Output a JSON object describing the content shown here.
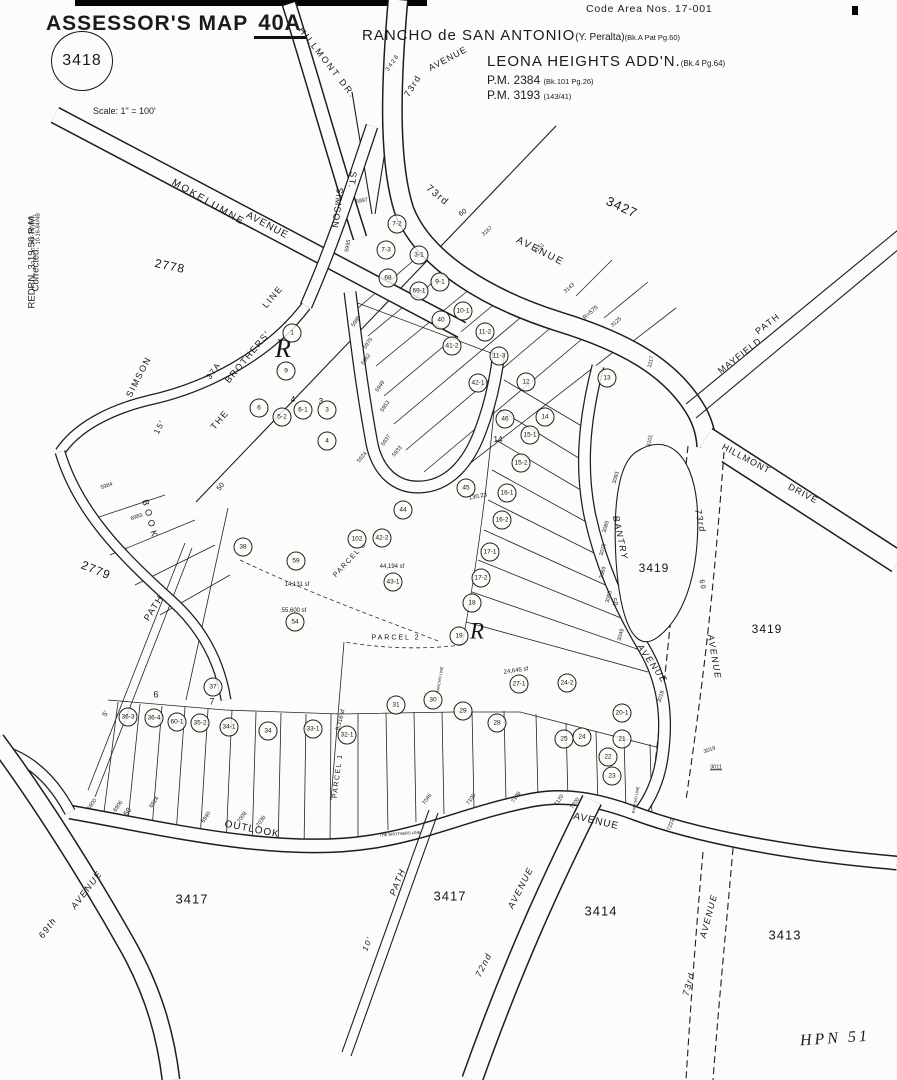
{
  "header": {
    "title": "ASSESSOR'S MAP",
    "map_number": "40A",
    "book_circle": "3418",
    "scale_label": "Scale: 1\" = 100'",
    "code_area": "Code Area Nos. 17-001",
    "rancho_line": "RANCHO de SAN ANTONIO",
    "rancho_sub": "(Y. Peralta)",
    "rancho_ref": "(Bk.A Pat Pg.60)",
    "addition_line": "LEONA HEIGHTS ADD'N.",
    "addition_ref": "(Bk.4 Pg.64)",
    "pm1": "P.M. 2384",
    "pm1_ref": "(Bk.101 Pg.26)",
    "pm2": "P.M. 3193",
    "pm2_ref": "(143/41)",
    "redrawn": "REDRN. 3-19-56 R.M.",
    "corrected_label": "Corrected:",
    "corrected_date1": "5-2-78/W78",
    "corrected_date2": "10-16-84/NB",
    "footer_mark": "HPN 51"
  },
  "map": {
    "street_labels": [
      {
        "t": "HILLMONT DR.",
        "x": 327,
        "y": 63,
        "r": 52,
        "fs": 9,
        "ls": 2
      },
      {
        "t": "73rd",
        "x": 413,
        "y": 86,
        "r": -58,
        "fs": 9
      },
      {
        "t": "AVENUE",
        "x": 448,
        "y": 59,
        "r": -28,
        "fs": 9,
        "ls": 1
      },
      {
        "t": "3428",
        "x": 393,
        "y": 63,
        "r": -55,
        "fs": 6
      },
      {
        "t": "MOKELUMNE",
        "x": 208,
        "y": 203,
        "r": 30,
        "fs": 10,
        "ls": 2
      },
      {
        "t": "AVENUE",
        "x": 267,
        "y": 226,
        "r": 28,
        "fs": 10,
        "ls": 1
      },
      {
        "t": "SIMSON",
        "x": 337,
        "y": 208,
        "r": 97,
        "fs": 9,
        "ls": 1
      },
      {
        "t": "ST.",
        "x": 352,
        "y": 180,
        "r": 97,
        "fs": 9
      },
      {
        "t": "73rd",
        "x": 437,
        "y": 196,
        "r": 40,
        "fs": 10
      },
      {
        "t": "AVENUE",
        "x": 540,
        "y": 252,
        "r": 27,
        "fs": 10,
        "ls": 2
      },
      {
        "t": "MAYFIELD",
        "x": 740,
        "y": 356,
        "r": -38,
        "fs": 9,
        "ls": 1
      },
      {
        "t": "PATH",
        "x": 768,
        "y": 324,
        "r": -38,
        "fs": 9
      },
      {
        "t": "HILLMONT",
        "x": 746,
        "y": 459,
        "r": 28,
        "fs": 9,
        "ls": 1
      },
      {
        "t": "DRIVE",
        "x": 803,
        "y": 494,
        "r": 28,
        "fs": 9,
        "ls": 1
      },
      {
        "t": "73rd",
        "x": 700,
        "y": 521,
        "r": 78,
        "fs": 9,
        "i": 1
      },
      {
        "t": "60",
        "x": 702,
        "y": 585,
        "r": 78,
        "fs": 7
      },
      {
        "t": "AVENUE",
        "x": 714,
        "y": 657,
        "r": 80,
        "fs": 9,
        "i": 1
      },
      {
        "t": "BANTRY",
        "x": 620,
        "y": 538,
        "r": 78,
        "fs": 9,
        "i": 1
      },
      {
        "t": "AVENUE",
        "x": 652,
        "y": 664,
        "r": 55,
        "fs": 9,
        "i": 1
      },
      {
        "t": "THE",
        "x": 220,
        "y": 420,
        "r": -50,
        "fs": 9
      },
      {
        "t": "BROTHERS'",
        "x": 248,
        "y": 357,
        "r": -50,
        "fs": 9
      },
      {
        "t": "LINE",
        "x": 273,
        "y": 297,
        "r": -50,
        "fs": 9
      },
      {
        "t": "37A",
        "x": 214,
        "y": 371,
        "r": -55,
        "fs": 8
      },
      {
        "t": "SIMSON",
        "x": 139,
        "y": 377,
        "r": -63,
        "fs": 9
      },
      {
        "t": "15'",
        "x": 160,
        "y": 427,
        "r": -63,
        "fs": 8
      },
      {
        "t": "BOOK",
        "x": 150,
        "y": 520,
        "r": 75,
        "fs": 9,
        "ls": 4
      },
      {
        "t": "PATH",
        "x": 154,
        "y": 608,
        "r": -58,
        "fs": 9
      },
      {
        "t": "OUTLOOK",
        "x": 252,
        "y": 830,
        "r": 11,
        "fs": 10,
        "ls": 1
      },
      {
        "t": "AVENUE",
        "x": 596,
        "y": 822,
        "r": 13,
        "fs": 10,
        "ls": 1
      },
      {
        "t": "69th",
        "x": 48,
        "y": 928,
        "r": -53,
        "fs": 9,
        "i": 1
      },
      {
        "t": "AVENUE",
        "x": 87,
        "y": 890,
        "r": -53,
        "fs": 9,
        "i": 1
      },
      {
        "t": "10'",
        "x": 368,
        "y": 944,
        "r": -68,
        "fs": 8,
        "i": 1
      },
      {
        "t": "PATH",
        "x": 398,
        "y": 882,
        "r": -68,
        "fs": 9,
        "i": 1
      },
      {
        "t": "72nd",
        "x": 484,
        "y": 965,
        "r": -63,
        "fs": 9,
        "i": 1
      },
      {
        "t": "AVENUE",
        "x": 521,
        "y": 888,
        "r": -63,
        "fs": 9,
        "i": 1
      },
      {
        "t": "73rd",
        "x": 689,
        "y": 984,
        "r": -75,
        "fs": 9,
        "i": 1
      },
      {
        "t": "AVENUE",
        "x": 709,
        "y": 916,
        "r": -75,
        "fs": 9,
        "i": 1
      },
      {
        "t": "PARCEL 1",
        "x": 338,
        "y": 776,
        "r": -83,
        "fs": 7
      },
      {
        "t": "PARCEL 2",
        "x": 396,
        "y": 638,
        "r": 0,
        "fs": 7,
        "ls": 2
      },
      {
        "t": "PARCEL 3",
        "x": 350,
        "y": 560,
        "r": -47,
        "fs": 7
      }
    ],
    "block_labels": [
      {
        "t": "3427",
        "x": 622,
        "y": 207,
        "r": 25,
        "fs": 13
      },
      {
        "t": "2778",
        "x": 170,
        "y": 266,
        "r": 12,
        "fs": 12
      },
      {
        "t": "2779",
        "x": 96,
        "y": 570,
        "r": 22,
        "fs": 12
      },
      {
        "t": "3419",
        "x": 654,
        "y": 568,
        "r": 0,
        "fs": 12
      },
      {
        "t": "3419",
        "x": 767,
        "y": 629,
        "r": 0,
        "fs": 12
      },
      {
        "t": "3417",
        "x": 192,
        "y": 899,
        "r": 0,
        "fs": 13
      },
      {
        "t": "3417",
        "x": 450,
        "y": 896,
        "r": 0,
        "fs": 13
      },
      {
        "t": "3414",
        "x": 601,
        "y": 911,
        "r": 0,
        "fs": 13
      },
      {
        "t": "3413",
        "x": 785,
        "y": 935,
        "r": 0,
        "fs": 13
      }
    ],
    "misc_labels": [
      {
        "t": "R",
        "x": 283,
        "y": 349,
        "r": 0,
        "fs": 26,
        "h": 1
      },
      {
        "t": "R",
        "x": 477,
        "y": 631,
        "r": 0,
        "fs": 23,
        "h": 1
      },
      {
        "t": "6",
        "x": 156,
        "y": 695,
        "r": 0,
        "fs": 9
      },
      {
        "t": "7",
        "x": 212,
        "y": 702,
        "r": 0,
        "fs": 9
      },
      {
        "t": "4",
        "x": 293,
        "y": 400,
        "r": 0,
        "fs": 8
      },
      {
        "t": "3",
        "x": 321,
        "y": 402,
        "r": 0,
        "fs": 8
      },
      {
        "t": "14",
        "x": 498,
        "y": 440,
        "r": 0,
        "fs": 8
      },
      {
        "t": "2",
        "x": 279,
        "y": 369,
        "r": 0,
        "fs": 7
      },
      {
        "t": "50",
        "x": 221,
        "y": 487,
        "r": -50,
        "fs": 7
      },
      {
        "t": "50",
        "x": 128,
        "y": 812,
        "r": -55,
        "fs": 7
      },
      {
        "t": "50",
        "x": 614,
        "y": 602,
        "r": 75,
        "fs": 7
      },
      {
        "t": "60",
        "x": 463,
        "y": 213,
        "r": -35,
        "fs": 7
      },
      {
        "t": "5'",
        "x": 106,
        "y": 714,
        "r": -58,
        "fs": 7
      },
      {
        "t": "R=575",
        "x": 591,
        "y": 313,
        "r": -42,
        "fs": 6
      },
      {
        "t": "130.23",
        "x": 478,
        "y": 497,
        "r": -10,
        "fs": 6
      },
      {
        "t": "14,131 sf",
        "x": 297,
        "y": 585,
        "r": 0,
        "fs": 6
      },
      {
        "t": "55,600 sf",
        "x": 294,
        "y": 611,
        "r": 0,
        "fs": 6
      },
      {
        "t": "44,194 sf",
        "x": 392,
        "y": 567,
        "r": 0,
        "fs": 6
      },
      {
        "t": "24,645 sf",
        "x": 516,
        "y": 671,
        "r": -8,
        "fs": 6
      },
      {
        "t": "8,316 sf",
        "x": 341,
        "y": 720,
        "r": -75,
        "fs": 6
      },
      {
        "t": "RANCHO LINE",
        "x": 440,
        "y": 680,
        "r": -80,
        "fs": 4
      },
      {
        "t": "RANCHO LINE",
        "x": 636,
        "y": 800,
        "r": -80,
        "fs": 4
      },
      {
        "t": "THE BROTHERS LINE",
        "x": 400,
        "y": 834,
        "r": -4,
        "fs": 4
      }
    ],
    "address_labels": [
      {
        "t": "5997",
        "x": 362,
        "y": 202,
        "r": -10
      },
      {
        "t": "5995",
        "x": 349,
        "y": 246,
        "r": -80
      },
      {
        "t": "5985",
        "x": 357,
        "y": 322,
        "r": -55
      },
      {
        "t": "5975",
        "x": 369,
        "y": 344,
        "r": -55
      },
      {
        "t": "5962",
        "x": 367,
        "y": 360,
        "r": -55
      },
      {
        "t": "5949",
        "x": 381,
        "y": 387,
        "r": -55
      },
      {
        "t": "5953",
        "x": 386,
        "y": 407,
        "r": -55
      },
      {
        "t": "5937",
        "x": 387,
        "y": 441,
        "r": -55
      },
      {
        "t": "5933",
        "x": 398,
        "y": 452,
        "r": -50
      },
      {
        "t": "5924",
        "x": 363,
        "y": 458,
        "r": -50
      },
      {
        "t": "5984",
        "x": 107,
        "y": 487,
        "r": -20
      },
      {
        "t": "6983",
        "x": 137,
        "y": 518,
        "r": -20
      },
      {
        "t": "3167",
        "x": 488,
        "y": 232,
        "r": -42
      },
      {
        "t": "3151",
        "x": 540,
        "y": 249,
        "r": -42
      },
      {
        "t": "3143",
        "x": 570,
        "y": 289,
        "r": -42
      },
      {
        "t": "3125",
        "x": 617,
        "y": 323,
        "r": -42
      },
      {
        "t": "3117",
        "x": 652,
        "y": 362,
        "r": -78
      },
      {
        "t": "3101",
        "x": 651,
        "y": 441,
        "r": -78
      },
      {
        "t": "3093",
        "x": 617,
        "y": 478,
        "r": -75
      },
      {
        "t": "3085",
        "x": 607,
        "y": 527,
        "r": -75
      },
      {
        "t": "3079",
        "x": 604,
        "y": 550,
        "r": -75
      },
      {
        "t": "3069",
        "x": 604,
        "y": 573,
        "r": -75
      },
      {
        "t": "3055",
        "x": 610,
        "y": 597,
        "r": -75
      },
      {
        "t": "3045",
        "x": 622,
        "y": 635,
        "r": -75
      },
      {
        "t": "3018",
        "x": 662,
        "y": 697,
        "r": -72
      },
      {
        "t": "3019",
        "x": 710,
        "y": 751,
        "r": -20
      },
      {
        "t": "3011",
        "x": 716,
        "y": 768,
        "r": 0,
        "u": 1
      },
      {
        "t": "6900",
        "x": 93,
        "y": 805,
        "r": -55
      },
      {
        "t": "6906",
        "x": 119,
        "y": 807,
        "r": -55
      },
      {
        "t": "6914",
        "x": 155,
        "y": 803,
        "r": -55
      },
      {
        "t": "6940",
        "x": 207,
        "y": 818,
        "r": -55
      },
      {
        "t": "7008",
        "x": 243,
        "y": 818,
        "r": -55
      },
      {
        "t": "7036",
        "x": 262,
        "y": 822,
        "r": -55
      },
      {
        "t": "7046",
        "x": 428,
        "y": 800,
        "r": -55
      },
      {
        "t": "7100",
        "x": 472,
        "y": 800,
        "r": -55
      },
      {
        "t": "7108",
        "x": 517,
        "y": 798,
        "r": -55
      },
      {
        "t": "7120",
        "x": 560,
        "y": 801,
        "r": -55
      },
      {
        "t": "7200",
        "x": 576,
        "y": 804,
        "r": -55
      },
      {
        "t": "7222",
        "x": 672,
        "y": 825,
        "r": -70
      }
    ],
    "parcels": [
      {
        "n": "7-2",
        "x": 397,
        "y": 224
      },
      {
        "n": "7-3",
        "x": 386,
        "y": 250
      },
      {
        "n": "3-1",
        "x": 419,
        "y": 255
      },
      {
        "n": "68",
        "x": 388,
        "y": 278
      },
      {
        "n": "9-1",
        "x": 440,
        "y": 282
      },
      {
        "n": "69-1",
        "x": 419,
        "y": 291
      },
      {
        "n": "10-1",
        "x": 463,
        "y": 311
      },
      {
        "n": "40",
        "x": 441,
        "y": 320
      },
      {
        "n": "11-2",
        "x": 485,
        "y": 332
      },
      {
        "n": "41-2",
        "x": 452,
        "y": 346
      },
      {
        "n": "11-3",
        "x": 499,
        "y": 356
      },
      {
        "n": "42-1",
        "x": 478,
        "y": 383
      },
      {
        "n": "12",
        "x": 526,
        "y": 382
      },
      {
        "n": "13",
        "x": 607,
        "y": 378
      },
      {
        "n": "1",
        "x": 292,
        "y": 333
      },
      {
        "n": "9",
        "x": 286,
        "y": 371
      },
      {
        "n": "6",
        "x": 259,
        "y": 408
      },
      {
        "n": "5-2",
        "x": 282,
        "y": 417
      },
      {
        "n": "6-1",
        "x": 303,
        "y": 410
      },
      {
        "n": "3",
        "x": 327,
        "y": 410
      },
      {
        "n": "4",
        "x": 327,
        "y": 441
      },
      {
        "n": "46",
        "x": 505,
        "y": 419
      },
      {
        "n": "14",
        "x": 545,
        "y": 417
      },
      {
        "n": "15-1",
        "x": 530,
        "y": 435
      },
      {
        "n": "15-2",
        "x": 521,
        "y": 463
      },
      {
        "n": "16-1",
        "x": 507,
        "y": 493
      },
      {
        "n": "16-2",
        "x": 502,
        "y": 520
      },
      {
        "n": "17-1",
        "x": 490,
        "y": 552
      },
      {
        "n": "17-2",
        "x": 481,
        "y": 578
      },
      {
        "n": "18",
        "x": 472,
        "y": 603
      },
      {
        "n": "19",
        "x": 459,
        "y": 636
      },
      {
        "n": "45",
        "x": 466,
        "y": 488
      },
      {
        "n": "44",
        "x": 403,
        "y": 510
      },
      {
        "n": "42-2",
        "x": 382,
        "y": 538
      },
      {
        "n": "102",
        "x": 357,
        "y": 539
      },
      {
        "n": "59",
        "x": 296,
        "y": 561
      },
      {
        "n": "54",
        "x": 295,
        "y": 622
      },
      {
        "n": "38",
        "x": 243,
        "y": 547
      },
      {
        "n": "43-1",
        "x": 393,
        "y": 582
      },
      {
        "n": "37",
        "x": 213,
        "y": 687
      },
      {
        "n": "36-3",
        "x": 128,
        "y": 717
      },
      {
        "n": "36-4",
        "x": 154,
        "y": 718
      },
      {
        "n": "60-1",
        "x": 177,
        "y": 722
      },
      {
        "n": "35-2",
        "x": 200,
        "y": 723
      },
      {
        "n": "34-1",
        "x": 229,
        "y": 727
      },
      {
        "n": "34",
        "x": 268,
        "y": 731
      },
      {
        "n": "33-1",
        "x": 313,
        "y": 729
      },
      {
        "n": "32-1",
        "x": 347,
        "y": 735
      },
      {
        "n": "31",
        "x": 396,
        "y": 705
      },
      {
        "n": "30",
        "x": 433,
        "y": 700
      },
      {
        "n": "29",
        "x": 463,
        "y": 711
      },
      {
        "n": "28",
        "x": 497,
        "y": 723
      },
      {
        "n": "27-1",
        "x": 519,
        "y": 684
      },
      {
        "n": "24-2",
        "x": 567,
        "y": 683
      },
      {
        "n": "20-1",
        "x": 622,
        "y": 713
      },
      {
        "n": "25",
        "x": 564,
        "y": 739
      },
      {
        "n": "24",
        "x": 582,
        "y": 737
      },
      {
        "n": "21",
        "x": 622,
        "y": 739
      },
      {
        "n": "22",
        "x": 608,
        "y": 757
      },
      {
        "n": "23",
        "x": 612,
        "y": 776
      }
    ]
  },
  "colors": {
    "ink": "#1b1b1b",
    "paper": "#fcfcfa"
  }
}
